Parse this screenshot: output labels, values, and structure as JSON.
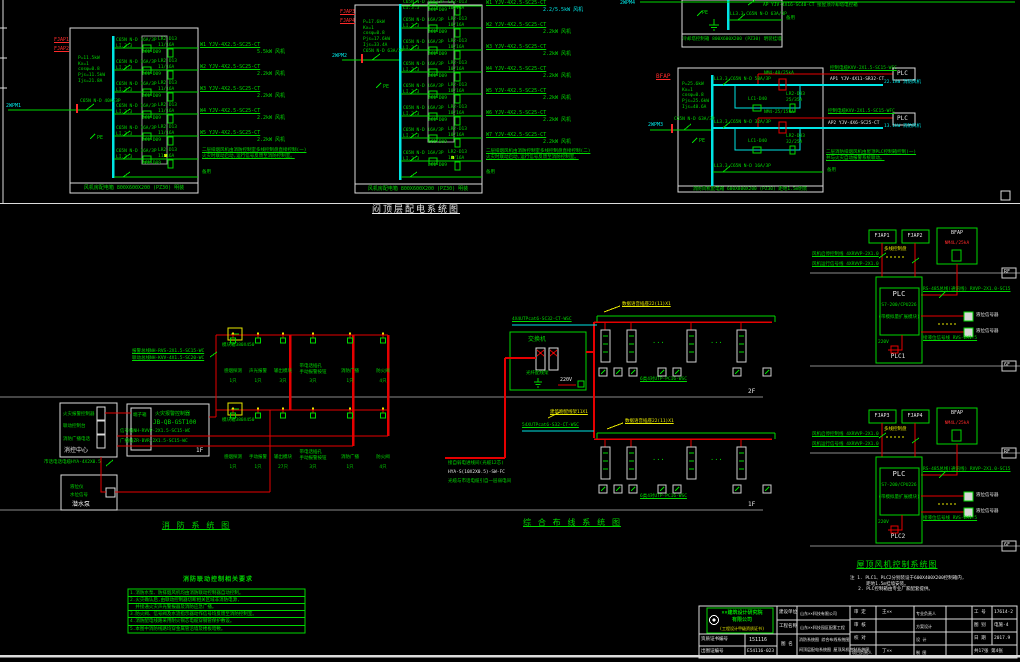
{
  "diagram_titles": {
    "top": "闷顶层配电系统图",
    "fire": "消 防 系 统 图",
    "cabling": "综 合 布 线 系 统 图",
    "fan": "屋顶风机控制系统图"
  },
  "markers": {
    "f2": "2F",
    "f1": "1F",
    "rf": "RF",
    "f6": "6F"
  },
  "p1": {
    "tag1": "FJAP1",
    "tag2": "FJAP2",
    "feeder_tag": "2WPM1",
    "feeder_breaker": "C65N N-D 40A/3P",
    "params": "P=11.5kW\nKx=1\ncosφ=0.8\nPjs=11.5kW\nIjs=21.8A",
    "pe": "PE",
    "breaker": "C65N N-D 16A/3P\nLI.3.3",
    "contactor": "LC1-D09",
    "thermal": "LR2-D13\n11/16A",
    "branches": [
      {
        "cable": "W1 YJV-4X2.5-SC25-CT",
        "load": "5.5kW 风机"
      },
      {
        "cable": "W2 YJV-4X2.5-SC25-CT",
        "load": "2.2kW 风机"
      },
      {
        "cable": "W3 YJV-4X2.5-SC25-CT",
        "load": "2.2kW 风机"
      },
      {
        "cable": "W4 YJV-4X2.5-SC25-CT",
        "load": "2.2kW 风机"
      },
      {
        "cable": "W5 YJV-4X2.5-SC25-CT",
        "load": "2.2kW 风机"
      }
    ],
    "note": "二层排烟风机由消防控制室多线控制盘直接控制(一)\n火灾时联动启动,运行信号反馈至消防控制室。",
    "spare": "备用",
    "bottom_label": "风机房配电箱 800X600X200 (PZ30) 明装"
  },
  "p2": {
    "tag1": "FJAP3",
    "tag2": "FJAP4",
    "feeder_tag": "2WPM2",
    "feeder_breaker": "C65N N-D 63A/3P",
    "params": "P=17.6kW\nKx=1\ncosφ=0.8\nPjs=17.6kW\nIjs=33.4A",
    "pe": "PE",
    "breaker": "C65N N-D 16A/3P\nLI.3.3",
    "contactor": "LC1-D09",
    "thermal": "LR2-D13\n10/16A",
    "branches": [
      {
        "cable": "W1 YJV-4X2.5-SC25-CT",
        "load": "2.2/5.5kW 风机"
      },
      {
        "cable": "W2 YJV-4X2.5-SC25-CT",
        "load": "2.2kW 风机"
      },
      {
        "cable": "W3 YJV-4X2.5-SC25-CT",
        "load": "2.2kW 风机"
      },
      {
        "cable": "W4 YJV-4X2.5-SC25-CT",
        "load": "2.2kW 风机"
      },
      {
        "cable": "W5 YJV-4X2.5-SC25-CT",
        "load": "2.2kW 风机"
      },
      {
        "cable": "W6 YJV-4X2.5-SC25-CT",
        "load": "2.2kW 风机"
      },
      {
        "cable": "W7 YJV-4X2.5-SC25-CT",
        "load": "2.2kW 风机"
      }
    ],
    "note": "二层排烟风机由消防控制室多线控制盘直接控制(二)\n火灾时联动启动,运行信号反馈至消防控制室。",
    "spare": "备用",
    "bottom_label": "风机房配电箱 800X600X200 (PZ30) 明装"
  },
  "p3": {
    "pe": "PE",
    "branch": "LL3.3 C65N N-D 63A/3P",
    "spare": "备用",
    "feeder_tag": "2WPM4",
    "top_cable": "AP YJV-4X16-SC40-CT 接屋顶冷却塔电控箱",
    "bottom_label": "冷却塔控制箱 800X600X200 (PZ30) 明装挂墙"
  },
  "p4": {
    "tag": "BFAP",
    "feeder_tag": "2WPM3",
    "feeder_breaker": "C65N N-D 63A/3P",
    "params": "P=25.6kW\nKx=1\ncosφ=0.8\nPjs=25.6kW\nIjs=48.6A",
    "pe": "PE",
    "b1": {
      "breaker": "LL3.3 C65N N-D 50A/3P",
      "protector": "NM4-40/25kA",
      "contactor": "LC1-D40",
      "thermal": "LR2-D33\n25/35A",
      "ctrl": "控制电缆KVV-2X1.5-SC15-WFC",
      "cable": "AP1 YJV-4X11-SR32-CT",
      "load": "22.1kW 消防风机",
      "plc": "PLC"
    },
    "b2": {
      "breaker": "LL3.3 C65N N-D 32A/3P",
      "protector": "NM4-25/15kA",
      "contactor": "LC1-D40",
      "thermal": "LR2-D33\n32/25A",
      "ctrl": "控制电缆KVV-2X1.5-SC15-WFC",
      "cable": "AP2 YJV-4X6-SC25-CT",
      "load": "13.1kW 消防风机",
      "plc": "PLC"
    },
    "note": "二层消防排烟风机由屋顶PLC控制箱控制(一)\n并与火灾自动报警系统联动。",
    "b3": {
      "breaker": "LL3.3 C65N N-D 16A/3P",
      "spare": "备用"
    },
    "bottom_label": "消防风机配电箱 600X800X200 (PZ30) 距地1.5m明装"
  },
  "fire": {
    "center": {
      "item1": "火灾报警控制器",
      "item2": "联动控制台",
      "item3": "消防广播电话",
      "label": "消控中心"
    },
    "pump": {
      "item1": "液位仪",
      "item2": "水位信号",
      "label": "潜水泵"
    },
    "ctrl": {
      "line1": "火灾报警控制器",
      "line2": "JB-QB-GST100",
      "terminal": "端子箱",
      "floor": "1F"
    },
    "cables": {
      "c1": "报警总线NH-RVS-2X1.5-SC15-WC",
      "c2": "联动总线NH-KVV-4X1.5-SC20-WC",
      "sig": "信号线NH-RVVP-2X1.5-SC15-WC",
      "bc": "广播线ZR-BVR-2X1.5-SC15-WC",
      "phone": "市话电话电缆HYA-4X2X0.5"
    },
    "module_label": "模块箱380X450",
    "rows": {
      "f2": [
        {
          "name": "感烟探测",
          "qty": "1只"
        },
        {
          "name": "声光报警",
          "qty": "1只"
        },
        {
          "name": "输出模块",
          "qty": "3只"
        },
        {
          "name": "带电话插孔\n手动报警按钮",
          "qty": "3只"
        },
        {
          "name": "消防广播",
          "qty": "1只"
        },
        {
          "name": "防火阀",
          "qty": "4只"
        }
      ],
      "f1": [
        {
          "name": "感烟探测",
          "qty": "1只"
        },
        {
          "name": "手动报警",
          "qty": "1只"
        },
        {
          "name": "输出模块",
          "qty": "27只"
        },
        {
          "name": "带电话插孔\n手动报警按钮",
          "qty": "3只"
        },
        {
          "name": "消防广播",
          "qty": "1只"
        },
        {
          "name": "防火阀",
          "qty": "4只"
        }
      ]
    }
  },
  "cabling": {
    "switch": "交换机",
    "odf": "光纤配线架",
    "v220": "220V",
    "cable_2f": "4X4UTPcat6-SC32-CT-WSC",
    "cable_1f": "54XUTPcat6-S32-CT-WSC",
    "mdf": "建筑物配线架11X1",
    "outlet_label": "数据语音插座22(11)X1",
    "horiz_cable": "6类4对UTP-PC16-WSC",
    "dots": "···",
    "src1": "接自弱电进线间(光缆12芯)",
    "src2": "HYA-S(10X2X0.5)-SW-FC",
    "src3": "光缆与市话电缆引自一层弱电间"
  },
  "fan1": {
    "tag1": "FJAP1",
    "tag2": "FJAP2",
    "tag3": "BFAP",
    "prot": "NM4L/25kA",
    "manual": "多线控制盘",
    "ctl": "风机启停控制线 4XRVVP-2X1.0",
    "sig": "风机运行信号线 4XRVVP-2X1.0",
    "plc": "PLC",
    "cpu": "S7-200/CPU226",
    "ai": "(带模拟量扩展模块)",
    "v220": "220V",
    "name": "PLC1",
    "rs485": "RS-485总线(通讯线) RVVP-2X1.0-SC15",
    "lvl": "接液位信号线 RVS-2X1.5",
    "sensor": "液位信号器"
  },
  "fan2": {
    "tag1": "FJAP3",
    "tag2": "FJAP4",
    "tag3": "BFAP",
    "prot": "NM4L/25kA",
    "manual": "多线控制盘",
    "ctl": "风机启停控制线 4XRVVP-2X1.0",
    "sig": "风机运行信号线 4XRVVP-2X1.0",
    "plc": "PLC",
    "cpu": "S7-200/CPU226",
    "ai": "(带模拟量扩展模块)",
    "v220": "220V",
    "name": "PLC2",
    "rs485": "RS-485总线(通讯线) RVVP-2X1.0-SC15",
    "lvl": "接液位信号线 RVS-2X1.5",
    "sensor": "液位信号器"
  },
  "fan_notes": "注 1. PLC1、PLC2分别装设于600X400X200控制箱内,\n      距地1.5m挂墙安装。\n   2. PLC控制箱由专业厂家配套提供。",
  "notes": {
    "title": "消防联动控制相关要求",
    "rows": [
      "1.消防水泵、防排烟风机均由消防联动控制器自动控制。",
      "2.火灾确认后,由联动控制器切断相关区域非消防电源,",
      "  并接通火灾声光警报器及消防应急广播。",
      "3.防火阀、信号阀及水流指示器动作信号均反馈至消防控制室。",
      "4.消防配电线路采用耐火铜芯电缆穿钢管保护敷设。",
      "5.本图中消防线路均穿金属管沿墙及楼板暗敷。"
    ]
  },
  "tb": {
    "company1": "××建筑设计研究院",
    "company2": "有限公司",
    "company3": "(工程设计甲级资质证书)",
    "cert_label": "资质证书编号",
    "cert_no": "151116",
    "chart_label": "出图证编号",
    "chart_no": "E54116-023",
    "owner_label": "建设单位",
    "owner": "山东××科技有限公司",
    "project_label": "工程名称",
    "project": "山东××科技园区配套工程",
    "sheet_label": "图 名",
    "sheet1": "消防系统图 综合布线系统图",
    "sheet2": "闷顶层配电系统图 屋顶风机控制系统图",
    "r1c1": "审 定",
    "r1v": "王××",
    "r1c3": "专业负责人",
    "r1c5": "工 号",
    "r1v5": "17614-2",
    "r2c1": "审 核",
    "r2c3": "方案设计",
    "r2c5": "图 别",
    "r2v5": "电施-4",
    "r3c1": "校 对",
    "r3c3": "设 计",
    "r3c5": "日 期",
    "r3v5": "2017.9",
    "r4c1": "项目负责人",
    "r4v": "丁××",
    "r4c3": "制 图",
    "r4span": "共17张 第4张"
  }
}
